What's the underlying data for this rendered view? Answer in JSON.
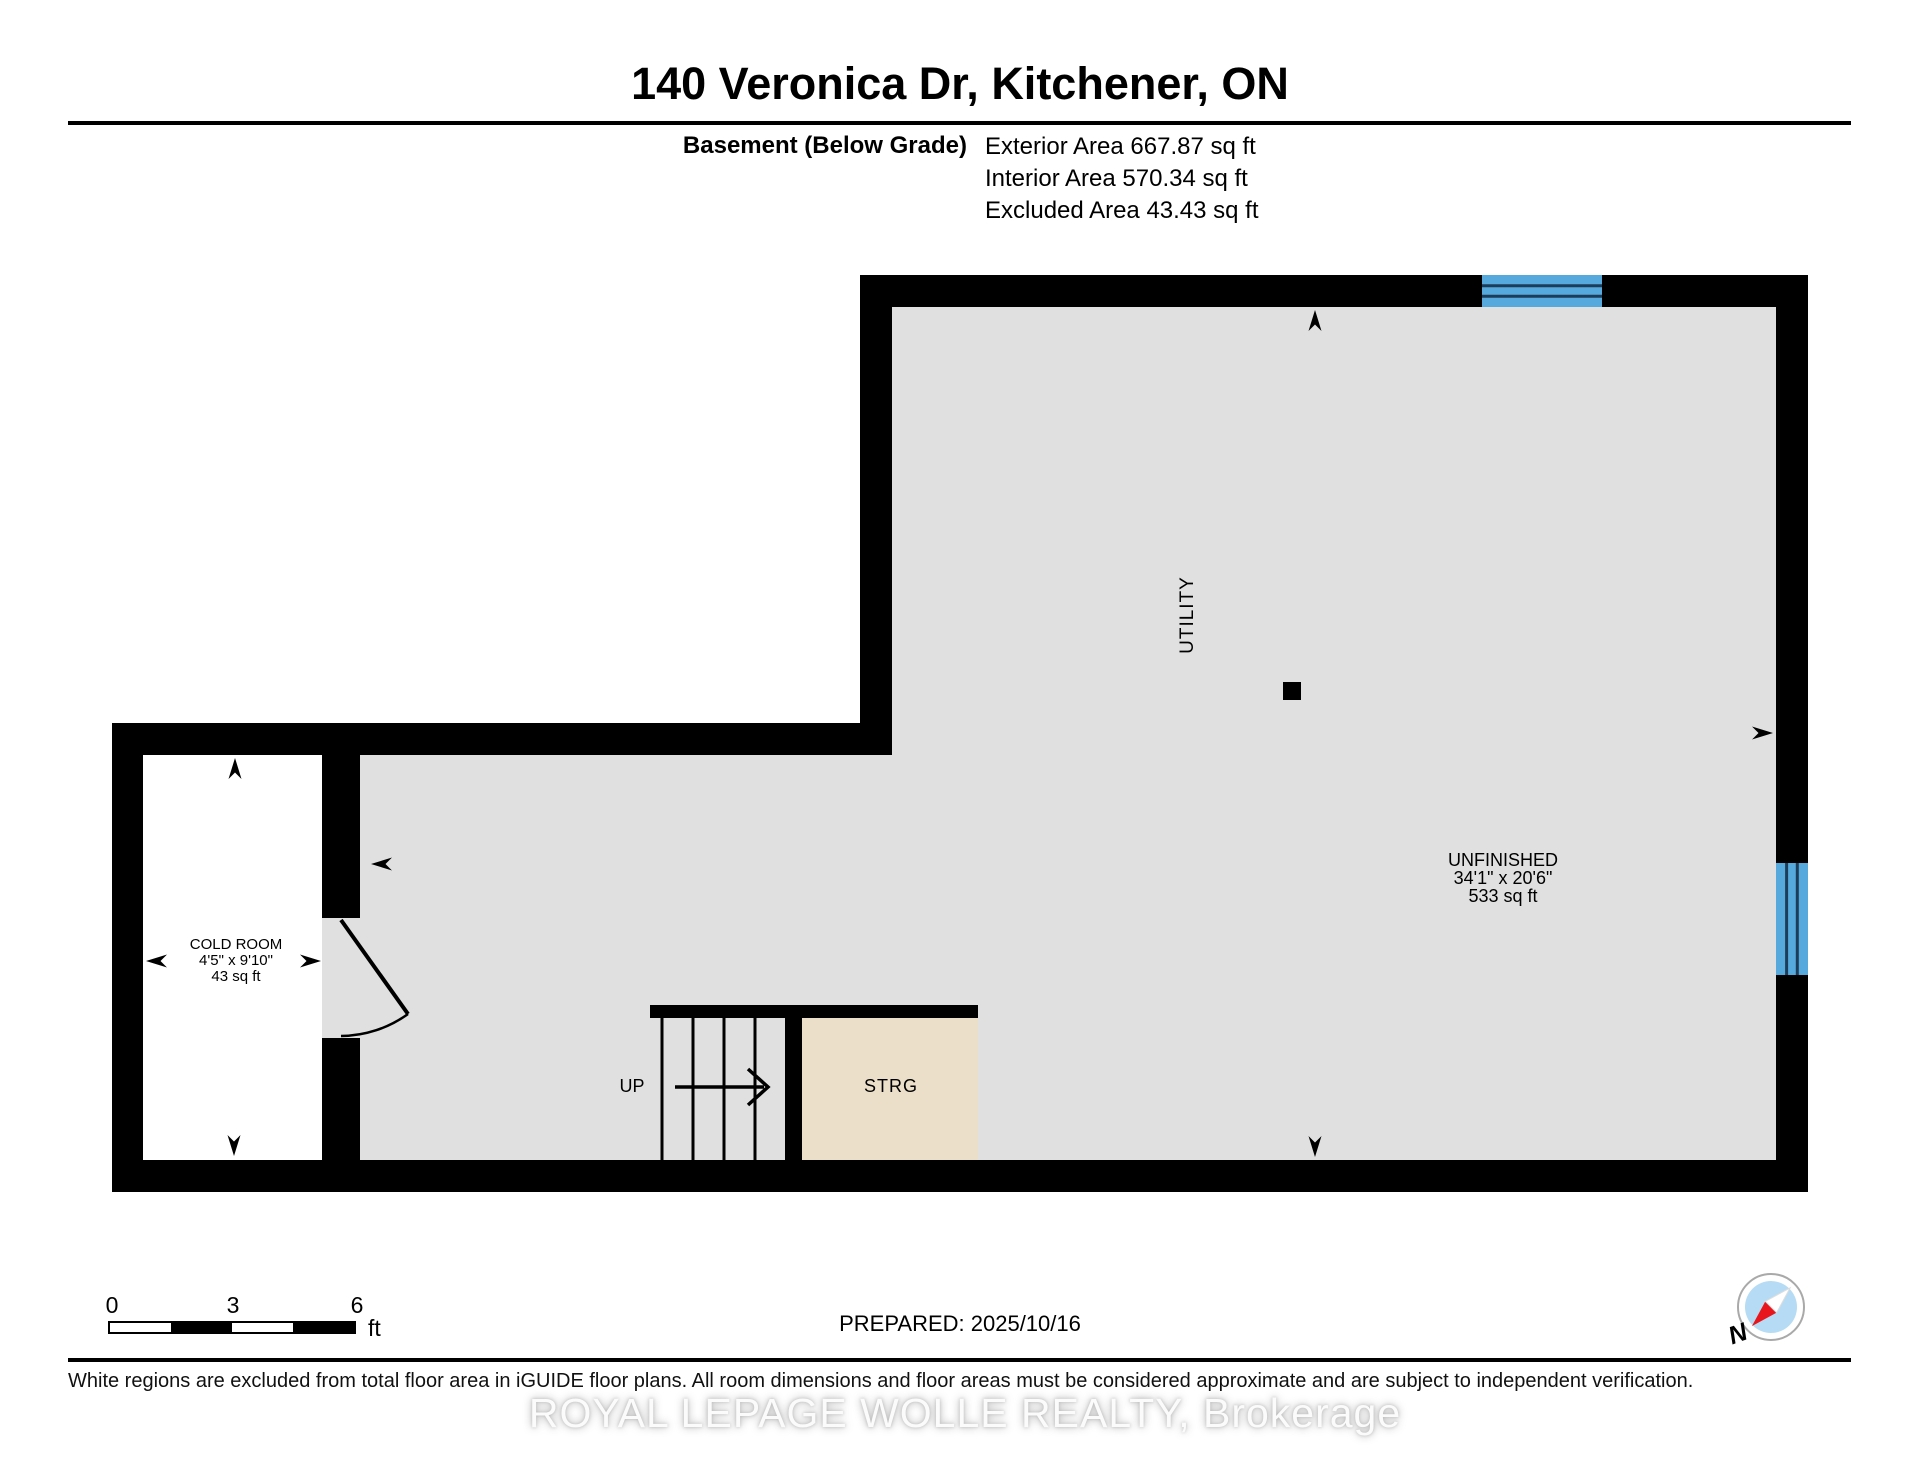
{
  "header": {
    "title": "140 Veronica Dr, Kitchener, ON",
    "floor_label": "Basement (Below Grade)",
    "area_exterior": "Exterior Area 667.87 sq ft",
    "area_interior": "Interior Area 570.34 sq ft",
    "area_excluded": "Excluded Area 43.43 sq ft"
  },
  "plan": {
    "rooms": {
      "utility": {
        "label": "UTILITY"
      },
      "unfinished": {
        "label": "UNFINISHED",
        "dimensions": "34'1\" x 20'6\"",
        "area": "533 sq ft"
      },
      "cold_room": {
        "label": "COLD ROOM",
        "dimensions": "4'5\" x 9'10\"",
        "area": "43 sq ft"
      },
      "storage": {
        "label": "STRG"
      },
      "stairs": {
        "label": "UP"
      }
    },
    "compass": {
      "label": "N"
    }
  },
  "footer": {
    "scale_bar": {
      "tick_start": "0",
      "tick_mid": "3",
      "tick_end": "6",
      "unit": "ft"
    },
    "prepared": "PREPARED: 2025/10/16",
    "disclaimer": "White regions are excluded from total floor area in iGUIDE floor plans. All room dimensions and floor areas must be considered approximate and are subject to independent verification.",
    "watermark": "ROYAL LEPAGE WOLLE REALTY, Brokerage"
  },
  "colors": {
    "wall": "#000000",
    "floor": "#e0e0e0",
    "excluded_floor": "#ffffff",
    "storage_floor": "#ecdfc9",
    "window": "#55a9dd",
    "window_mullion": "#1d3c5a",
    "compass_red": "#e8161c",
    "compass_blue": "#b5dcf4"
  }
}
